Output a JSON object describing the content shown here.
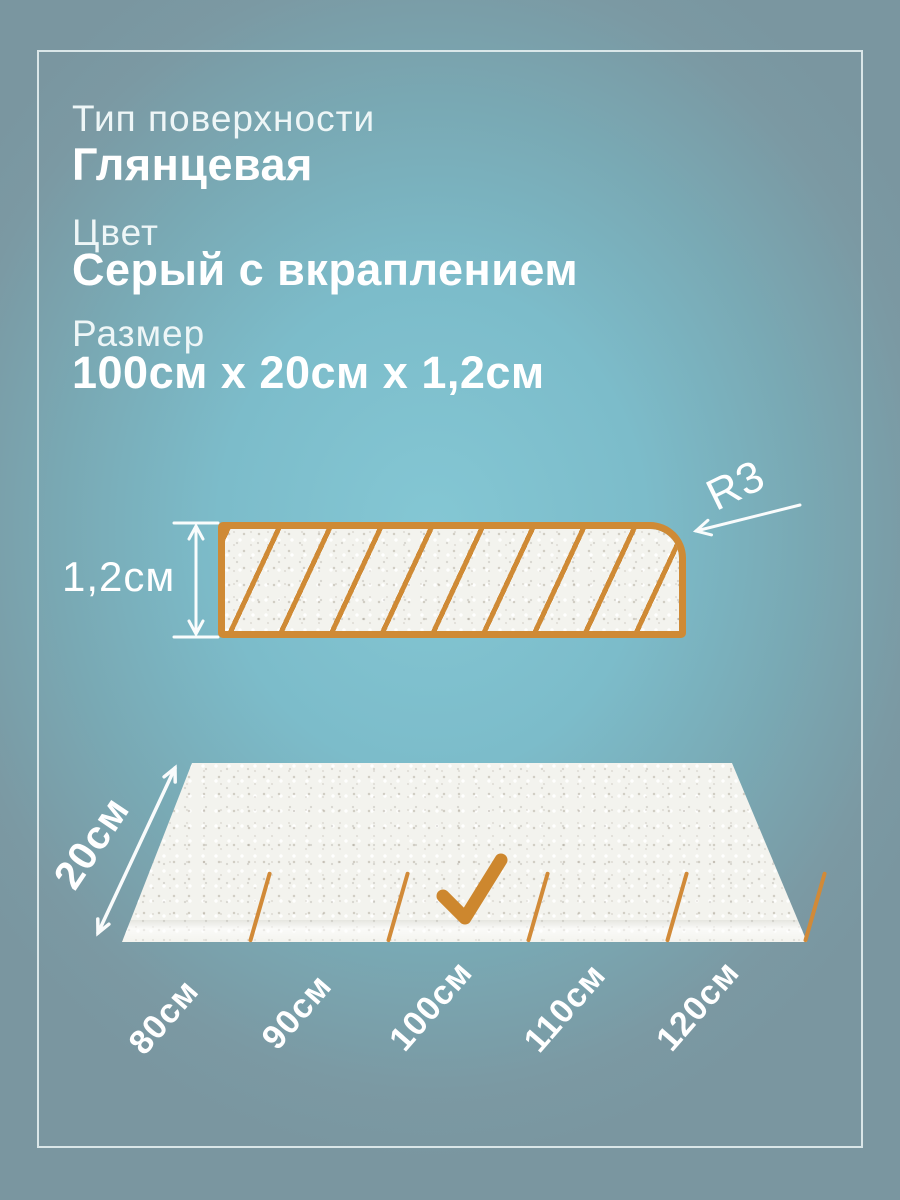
{
  "specs": [
    {
      "label": "Тип поверхности",
      "value": "Глянцевая"
    },
    {
      "label": "Цвет",
      "value": "Серый с вкраплением"
    },
    {
      "label": "Размер",
      "value": "100см x 20см x 1,2см"
    }
  ],
  "cross_section": {
    "thickness_label": "1,2см",
    "radius_label": "R3"
  },
  "panel": {
    "width_label": "20см",
    "length_options": [
      "80см",
      "90см",
      "100см",
      "110см",
      "120см"
    ],
    "selected_length": "100см"
  },
  "colors": {
    "accent_orange": "#CF8A35",
    "background_center": "#84C7D4",
    "background_edge": "#7A96A0",
    "surface_speckled_white": "#F3F3EE",
    "text_white": "#FFFFFF",
    "frame_line": "#E4EEF0"
  }
}
